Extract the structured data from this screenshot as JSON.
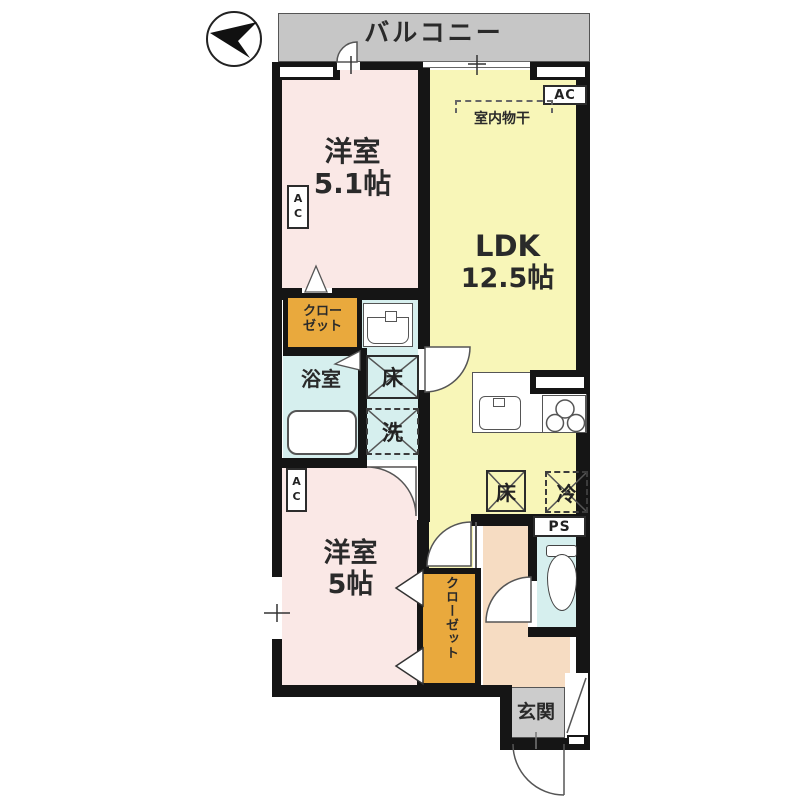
{
  "balcony": {
    "label": "バルコニー"
  },
  "rooms": {
    "bedroom1": {
      "name": "洋室",
      "size": "5.1帖",
      "ac": "AC"
    },
    "ldk": {
      "name": "LDK",
      "size": "12.5帖",
      "ac": "AC",
      "laundry": "室内物干"
    },
    "bedroom2": {
      "name": "洋室",
      "size": "5帖",
      "ac": "AC"
    },
    "bathroom": {
      "label": "浴室"
    },
    "toilet": {
      "ps": "PS"
    },
    "entrance": {
      "label": "玄関"
    },
    "closet1": {
      "line1": "クロー",
      "line2": "ゼット"
    },
    "closet2": {
      "label": "クローゼット"
    }
  },
  "markers": {
    "floor_hatch_wash": "床",
    "washing_machine": "洗",
    "floor_hatch_ldk": "床",
    "refrigerator": "冷"
  },
  "colors": {
    "wall": "#151515",
    "bedroom_pink": "#fae8e6",
    "ldk_yellow": "#f8f6b8",
    "closet_orange": "#e9a93d",
    "wet_area_cyan": "#d6efee",
    "hall_peach": "#f6dcc2",
    "balcony_gray": "#c6c6c6",
    "entrance_gray": "#cccccc"
  }
}
